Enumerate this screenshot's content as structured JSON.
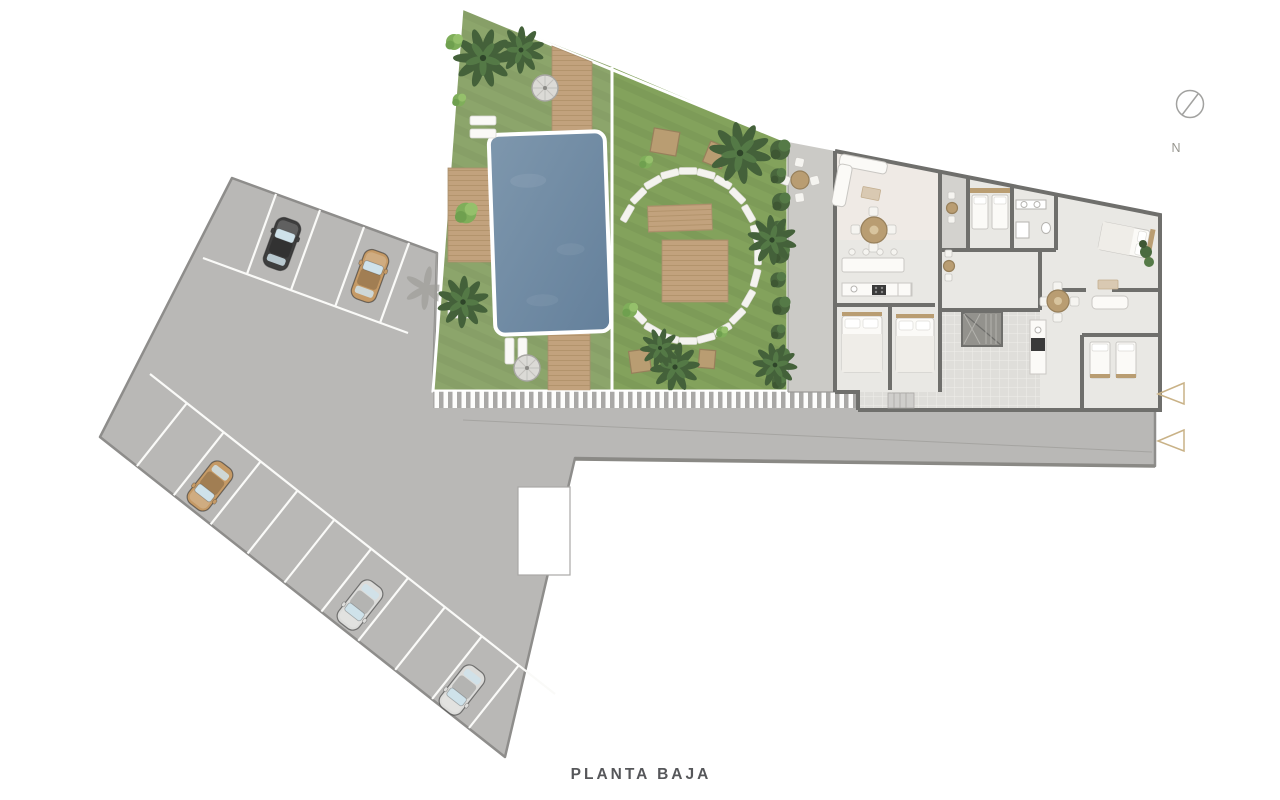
{
  "title": "PLANTA BAJA",
  "compass_label": "N",
  "palette": {
    "car_black": "#3E3E3E",
    "car_tan": "#C59A66",
    "car_silver": "#DCDCDA",
    "marker_gold": "#C9B287",
    "pool_top": "#7E97AD",
    "pool_bottom": "#64809B",
    "grass": "#8CA56B",
    "grass_bright": "#83A25C",
    "deck_wood": "#C2A27D",
    "parking_surface": "#B9B8B6",
    "surface_border": "#8E8D8B",
    "wall": "#6F6F6C",
    "building_floor": "#E9E8E4",
    "terrace_floor": "#CBCAC6",
    "stripe_walkway": "#A9A8A6",
    "hedge_green": "#49663D",
    "furniture_wood": "#B99D72",
    "title_color": "#56575A"
  },
  "inventory": {
    "parking": {
      "rows": 2,
      "cars": [
        {
          "row": "top",
          "color": "black"
        },
        {
          "row": "top",
          "color": "tan"
        },
        {
          "row": "bottom",
          "color": "tan"
        },
        {
          "row": "bottom",
          "color": "silver"
        },
        {
          "row": "bottom",
          "color": "silver"
        }
      ]
    },
    "garden": {
      "pool": 1,
      "parasols": 2,
      "sun_loungers": 6,
      "stepping_stones": 20,
      "wood_decks": 5,
      "palm_trees": 8
    },
    "building": {
      "apartments": 2,
      "terraces": 3,
      "stair_core": 1
    },
    "direction_markers": {
      "count": 2,
      "shape": "triangle-left"
    }
  }
}
